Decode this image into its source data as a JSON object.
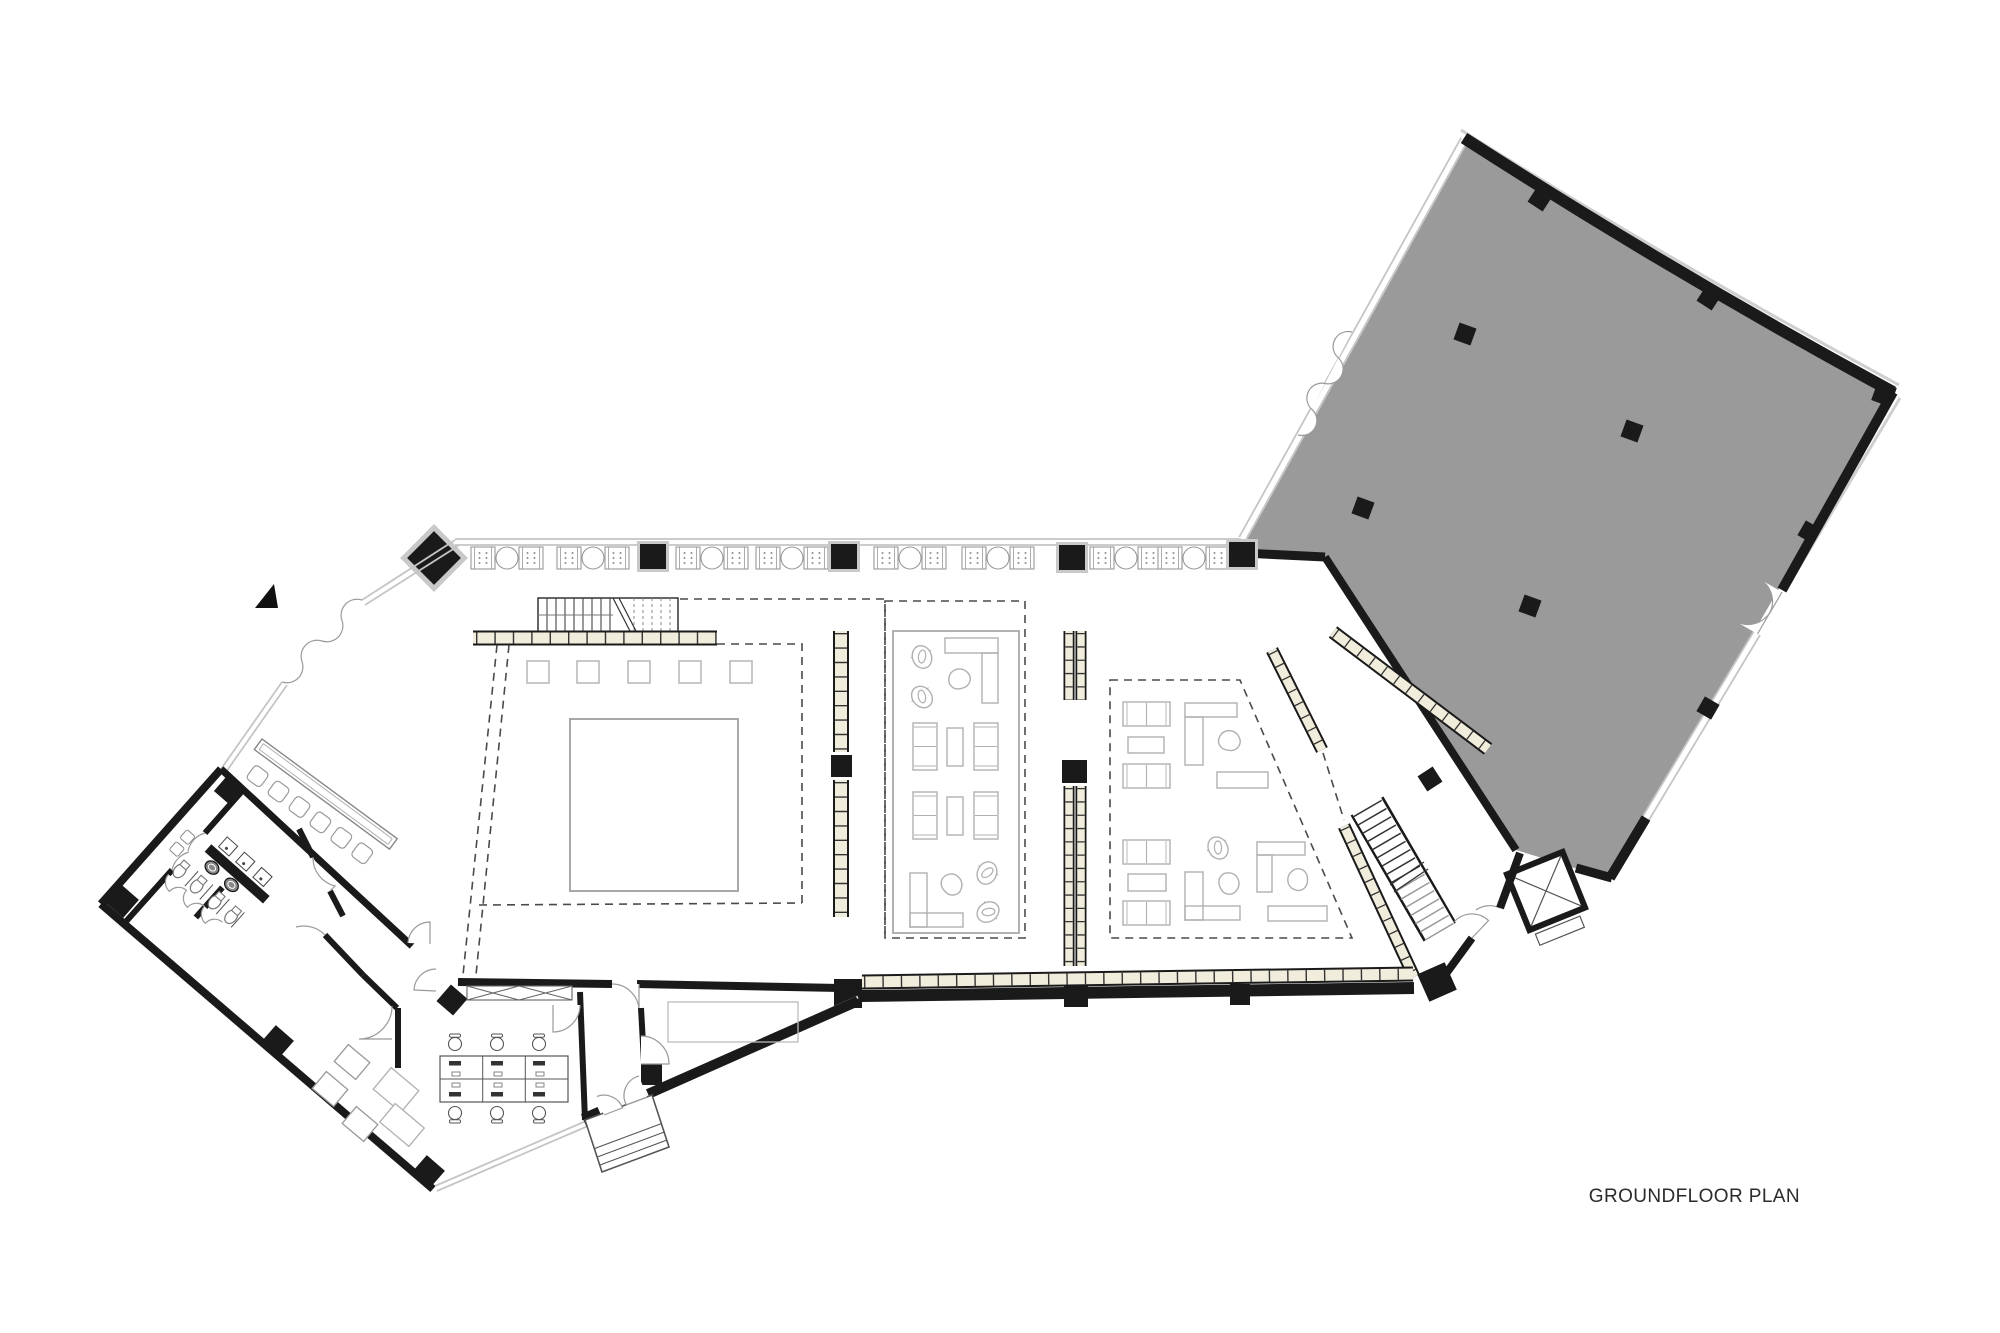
{
  "plan": {
    "title": "GROUNDFLOOR PLAN"
  },
  "colors": {
    "wall": "#1a1a1a",
    "hall_fill": "#9a9a9a",
    "window_line": "#c5c5c5",
    "dash_line": "#4a4a4a",
    "furniture_line": "#b0b0b0",
    "detail_line": "#555555",
    "ledge_fill": "#f1eddc",
    "text_color": "#2b2b2b"
  },
  "icons": {
    "north_arrow": "north-arrow-icon"
  }
}
